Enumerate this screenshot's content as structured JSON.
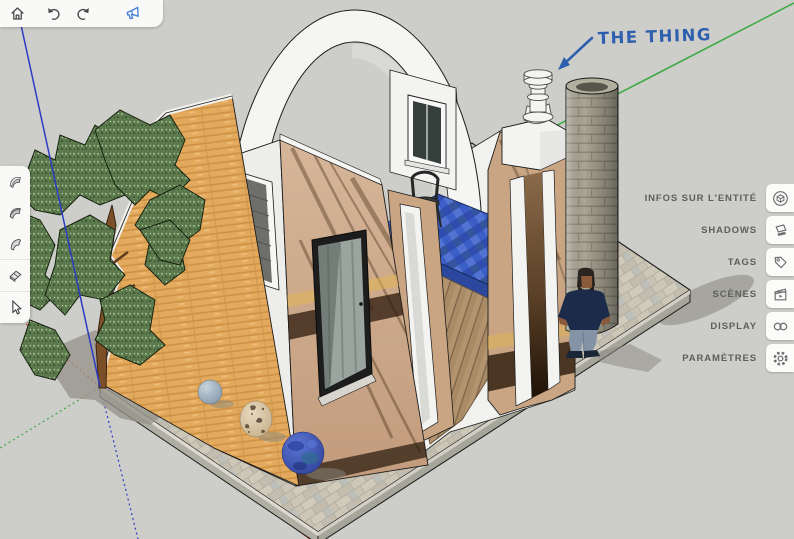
{
  "toolbar_top": {
    "icons": [
      {
        "name": "home-icon"
      },
      {
        "name": "undo-icon"
      },
      {
        "name": "redo-icon"
      },
      {
        "name": "feedback-megaphone-icon",
        "color": "#3a7ad9"
      }
    ]
  },
  "toolbar_left": {
    "tools": [
      {
        "name": "surface-tool-1"
      },
      {
        "name": "surface-tool-2"
      },
      {
        "name": "surface-tool-3"
      },
      {
        "name": "eraser-tool"
      },
      {
        "name": "select-tool"
      }
    ]
  },
  "right_panel": {
    "items": [
      {
        "label": "INFOS SUR L'ENTITÉ",
        "icon": "entity-info-icon"
      },
      {
        "label": "SHADOWS",
        "icon": "shadows-icon"
      },
      {
        "label": "TAGS",
        "icon": "tag-icon"
      },
      {
        "label": "SCÈNES",
        "icon": "scenes-icon"
      },
      {
        "label": "DISPLAY",
        "icon": "display-icon"
      },
      {
        "label": "PARAMÈTRES",
        "icon": "settings-icon"
      }
    ]
  },
  "canvas": {
    "background": "#cdcdc9",
    "annotation": {
      "text": "THE THING",
      "color": "#2e5fae"
    },
    "axes": {
      "red": "#d23c32",
      "green": "#3faa46",
      "blue": "#2c3cc4"
    },
    "objects": [
      "paved-platform",
      "tree",
      "orange-brick-wall",
      "cutaway-house",
      "arch",
      "framed-picture",
      "glass-door",
      "window",
      "pool",
      "chair",
      "wood-floor",
      "portal",
      "chimney-vent",
      "brick-column",
      "person-figure",
      "sphere-gray",
      "sphere-travertine",
      "sphere-blue"
    ]
  }
}
